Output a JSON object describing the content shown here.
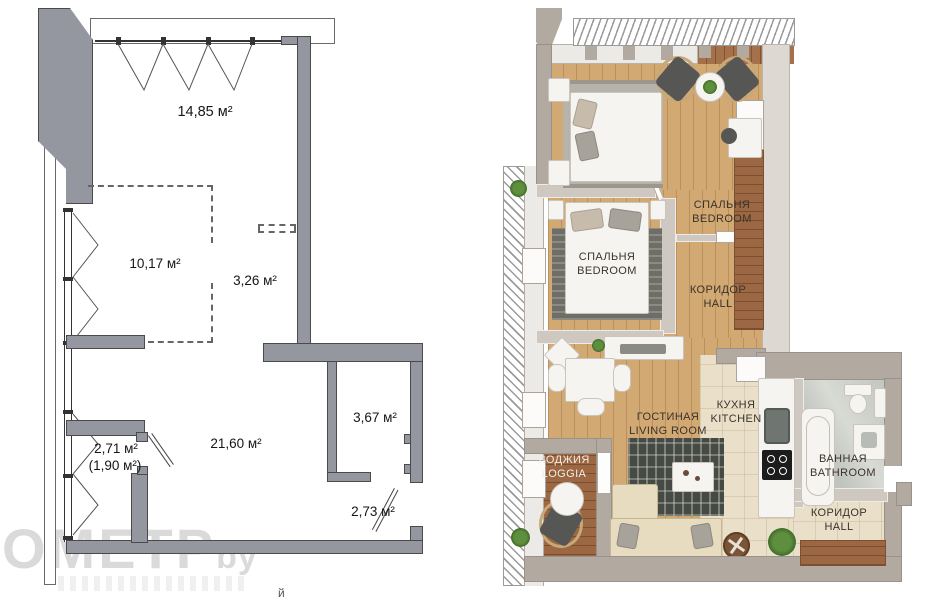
{
  "meta": {
    "description": "Two apartment floor plans side by side: technical measured plan (left) and furnished render plan (right)"
  },
  "watermark": {
    "text": "ОМЕТР",
    "suffix": "by",
    "stray_char": "й"
  },
  "colors": {
    "plan_wall_gray": "#94979f",
    "render_wall": "#b2a9a0",
    "wood_floor": "#d2a873",
    "dark_wood": "#9c6843",
    "tile_floor": "#eae0ca",
    "label_text": "#3a332c"
  },
  "left_plan": {
    "areas": [
      {
        "label": "14,85 м²"
      },
      {
        "label": "10,17 м²"
      },
      {
        "label": "3,26 м²"
      },
      {
        "label": "21,60 м²"
      },
      {
        "label": "3,67 м²"
      },
      {
        "label": "2,71 м²"
      },
      {
        "label": "(1,90 м²)"
      },
      {
        "label": "2,73 м²"
      }
    ]
  },
  "right_plan": {
    "rooms": [
      {
        "id": "bedroom-1",
        "label_ru": "СПАЛЬНЯ",
        "label_en": "BEDROOM"
      },
      {
        "id": "bedroom-2",
        "label_ru": "СПАЛЬНЯ",
        "label_en": "BEDROOM"
      },
      {
        "id": "hall-1",
        "label_ru": "КОРИДОР",
        "label_en": "HALL"
      },
      {
        "id": "living-room",
        "label_ru": "ГОСТИНАЯ",
        "label_en": "LIVING ROOM"
      },
      {
        "id": "kitchen",
        "label_ru": "КУХНЯ",
        "label_en": "KITCHEN"
      },
      {
        "id": "loggia",
        "label_ru": "ЛОДЖИЯ",
        "label_en": "LOGGIA"
      },
      {
        "id": "bathroom",
        "label_ru": "ВАННАЯ",
        "label_en": "BATHROOM"
      },
      {
        "id": "hall-2",
        "label_ru": "КОРИДОР",
        "label_en": "HALL"
      }
    ]
  }
}
